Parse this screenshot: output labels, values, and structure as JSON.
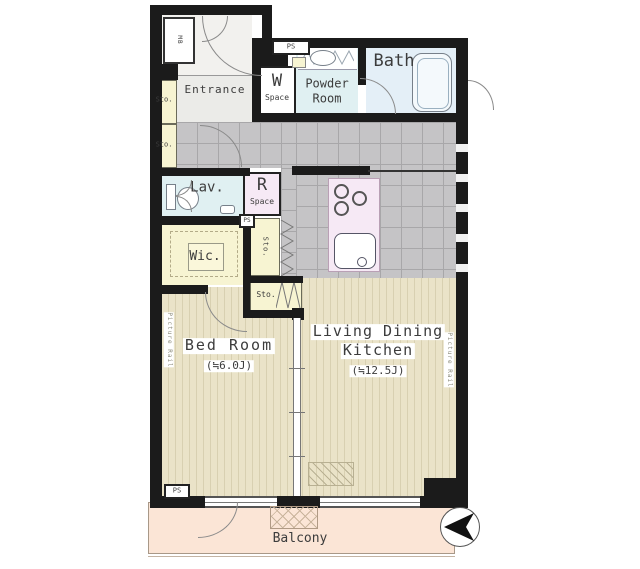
{
  "rooms": {
    "entrance": {
      "label": "Entrance"
    },
    "w_space": {
      "initial": "W",
      "sub": "Space"
    },
    "powder_room": {
      "line1": "Powder",
      "line2": "Room"
    },
    "bath": {
      "label": "Bath"
    },
    "lav": {
      "label": "Lav."
    },
    "r_space": {
      "initial": "R",
      "sub": "Space"
    },
    "wic": {
      "label": "Wic."
    },
    "bed_room": {
      "label": "Bed Room",
      "size": "(≒6.0J)"
    },
    "ldk": {
      "line1": "Living Dining",
      "line2": "Kitchen",
      "size": "(≒12.5J)"
    },
    "balcony": {
      "label": "Balcony"
    }
  },
  "storage_labels": {
    "left_top": "Sto.",
    "left_bottom": "Sto.",
    "mid_vertical": "Sto.",
    "mid_lower": "Sto."
  },
  "service_labels": {
    "ps_top": "PS",
    "ps_middle": "PS",
    "ps_bottom": "PS",
    "meter_box": "MB"
  },
  "wall_annotations": {
    "picture_rail_left": "Picture Rail",
    "picture_rail_right": "Picture Rail"
  },
  "colors": {
    "wall": "#1b1b1b",
    "wood_floor": "#eae3c8",
    "tile_floor": "#c5c4c6",
    "storage_yellow": "#f7f4d2",
    "wet_area_cyan": "#e0f0f2",
    "bath_blue": "#e4eff7",
    "kitchen_pink": "#f6e9f5",
    "balcony_peach": "#fbe5d6"
  }
}
